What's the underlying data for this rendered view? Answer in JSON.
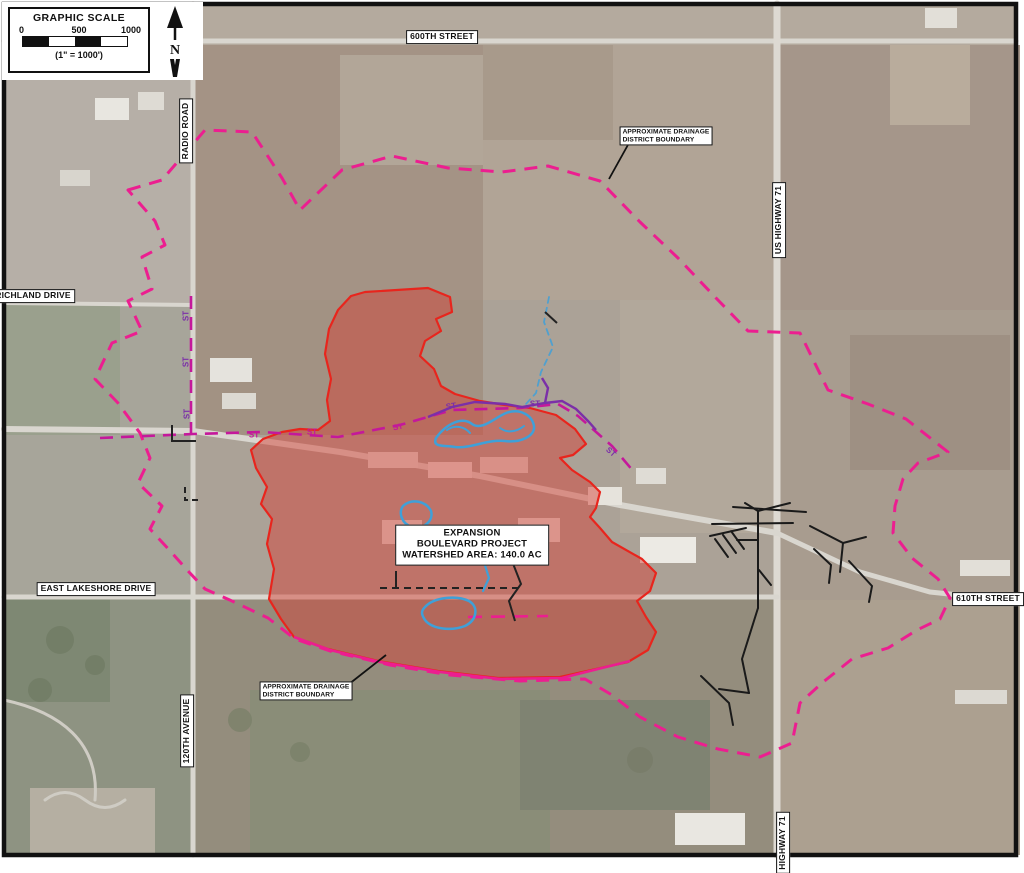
{
  "map": {
    "scale_box": {
      "title": "GRAPHIC SCALE",
      "ticks": [
        "0",
        "500",
        "1000"
      ],
      "ratio_note": "(1\" = 1000')",
      "north_label": "N"
    },
    "road_labels": [
      {
        "id": "600th-street",
        "text": "600TH STREET",
        "orientation": "horizontal"
      },
      {
        "id": "radio-road",
        "text": "RADIO ROAD",
        "orientation": "vertical"
      },
      {
        "id": "richland-drive",
        "text": "RICHLAND DRIVE",
        "orientation": "horizontal"
      },
      {
        "id": "us-highway-71",
        "text": "US HIGHWAY 71",
        "orientation": "vertical"
      },
      {
        "id": "east-lakeshore-drive",
        "text": "EAST LAKESHORE DRIVE",
        "orientation": "horizontal"
      },
      {
        "id": "610th-street",
        "text": "610TH STREET",
        "orientation": "horizontal"
      },
      {
        "id": "120th-avenue",
        "text": "120TH AVENUE",
        "orientation": "vertical"
      },
      {
        "id": "highway-71",
        "text": "HIGHWAY 71",
        "orientation": "vertical"
      }
    ],
    "annotations": {
      "drainage_boundary_top": {
        "line1": "APPROXIMATE DRAINAGE",
        "line2": "DISTRICT BOUNDARY"
      },
      "drainage_boundary_bottom": {
        "line1": "APPROXIMATE DRAINAGE",
        "line2": "DISTRICT BOUNDARY"
      },
      "watershed_box": {
        "line1": "EXPANSION",
        "line2": "BOULEVARD PROJECT",
        "line3": "WATERSHED AREA: 140.0 AC"
      }
    },
    "storm_sewer_label": "ST",
    "colors": {
      "district_boundary_magenta": "#EC1E90",
      "watershed_outline_red": "#E8251D",
      "watershed_fill_red": "#D64036",
      "storm_sewer_magenta": "#C4189B",
      "storm_sewer_purple": "#7B2FA8",
      "stream_blue": "#3FA0D8",
      "tile_line_black": "#1A1A1A"
    }
  }
}
